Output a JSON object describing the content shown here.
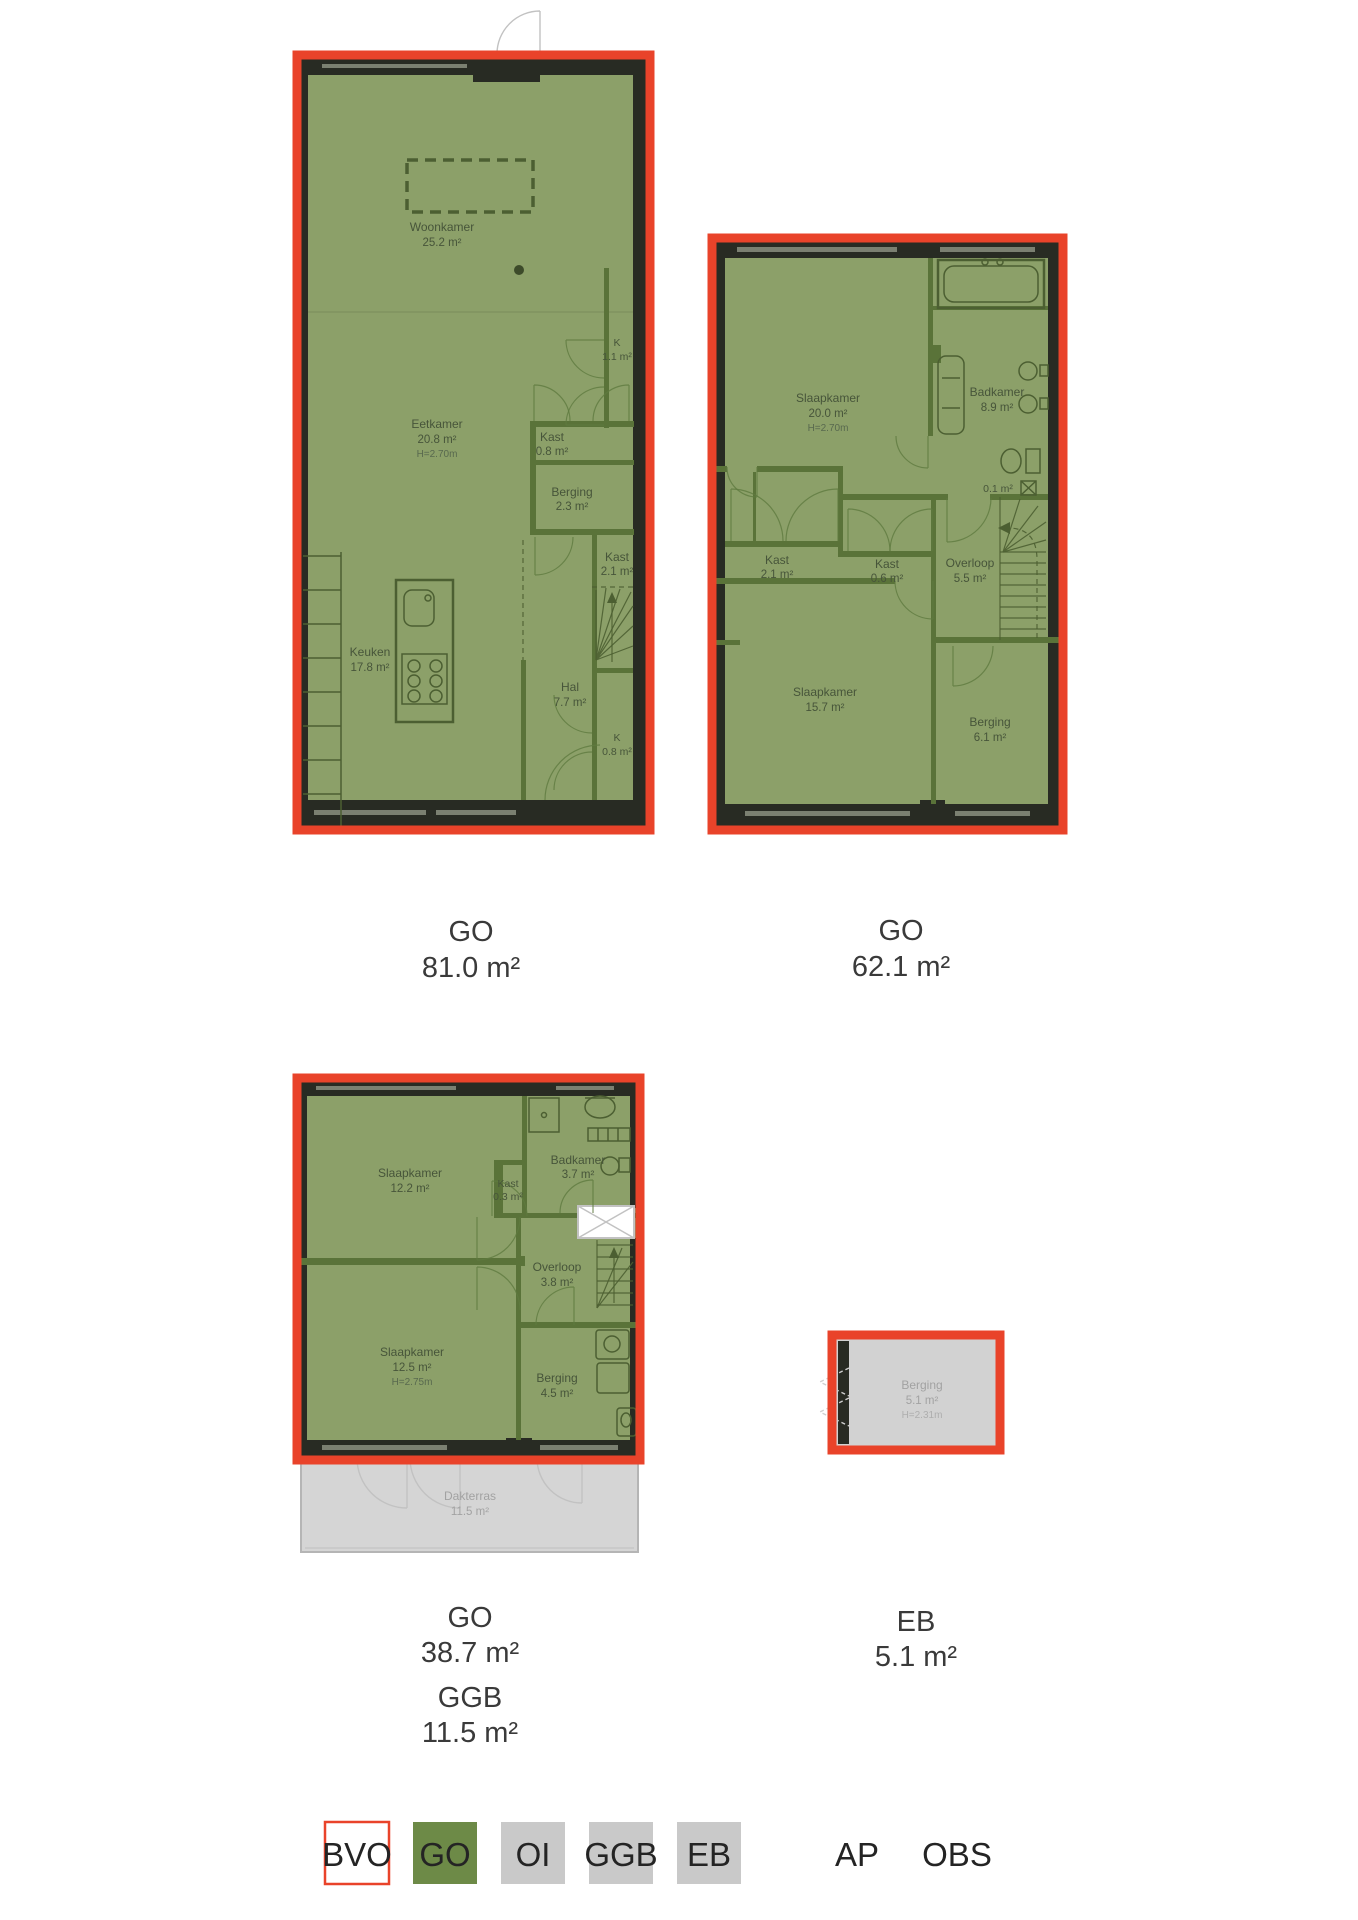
{
  "colors": {
    "bvo_red": "#e9432a",
    "go_green_fill": "#8ca069",
    "legend_go_green": "#6d8a47",
    "legend_gray": "#c9c9c9",
    "legend_bvo_fill": "#ffffff",
    "wall_dark": "#282b23",
    "wall_green": "#5a7339",
    "gray_area": "#d5d5d5",
    "summary_text": "#3a3a3a"
  },
  "plans": [
    {
      "id": "first-floor",
      "rooms": [
        {
          "name": "Woonkamer",
          "area": "25.2 m²"
        },
        {
          "name": "Eetkamer",
          "area": "20.8 m²",
          "height": "H=2.70m"
        },
        {
          "name": "K",
          "area": "1.1 m²"
        },
        {
          "name": "Kast",
          "area": "0.8 m²"
        },
        {
          "name": "Berging",
          "area": "2.3 m²"
        },
        {
          "name": "Kast",
          "area": "2.1 m²"
        },
        {
          "name": "Keuken",
          "area": "17.8 m²"
        },
        {
          "name": "Hal",
          "area": "7.7 m²"
        },
        {
          "name": "K",
          "area": "0.8 m²"
        }
      ],
      "summary": [
        {
          "code": "GO",
          "value": "81.0 m²"
        }
      ]
    },
    {
      "id": "second-floor",
      "rooms": [
        {
          "name": "Slaapkamer",
          "area": "20.0 m²",
          "height": "H=2.70m"
        },
        {
          "name": "Badkamer",
          "area": "8.9 m²"
        },
        {
          "area": "0.1 m²"
        },
        {
          "name": "Kast",
          "area": "2.1 m²"
        },
        {
          "name": "Kast",
          "area": "0.6 m²"
        },
        {
          "name": "Overloop",
          "area": "5.5 m²"
        },
        {
          "name": "Slaapkamer",
          "area": "15.7 m²"
        },
        {
          "name": "Berging",
          "area": "6.1 m²"
        }
      ],
      "summary": [
        {
          "code": "GO",
          "value": "62.1 m²"
        }
      ]
    },
    {
      "id": "third-floor",
      "rooms": [
        {
          "name": "Slaapkamer",
          "area": "12.2 m²"
        },
        {
          "name": "Kast",
          "area": "0.3 m²"
        },
        {
          "name": "Badkamer",
          "area": "3.7 m²"
        },
        {
          "name": "Overloop",
          "area": "3.8 m²"
        },
        {
          "name": "Slaapkamer",
          "area": "12.5 m²",
          "height": "H=2.75m"
        },
        {
          "name": "Berging",
          "area": "4.5 m²"
        },
        {
          "name": "Dakterras",
          "area": "11.5 m²"
        }
      ],
      "summary": [
        {
          "code": "GO",
          "value": "38.7 m²"
        },
        {
          "code": "GGB",
          "value": "11.5 m²"
        }
      ]
    },
    {
      "id": "external-storage",
      "rooms": [
        {
          "name": "Berging",
          "area": "5.1 m²",
          "height": "H=2.31m"
        }
      ],
      "summary": [
        {
          "code": "EB",
          "value": "5.1 m²"
        }
      ]
    }
  ],
  "legend": {
    "items": [
      {
        "label": "BVO",
        "fill": "#ffffff",
        "border": "#e9432a"
      },
      {
        "label": "GO",
        "fill": "#6d8a47"
      },
      {
        "label": "OI",
        "fill": "#c9c9c9"
      },
      {
        "label": "GGB",
        "fill": "#c9c9c9"
      },
      {
        "label": "EB",
        "fill": "#c9c9c9"
      },
      {
        "label": "AP"
      },
      {
        "label": "OBS"
      }
    ]
  }
}
